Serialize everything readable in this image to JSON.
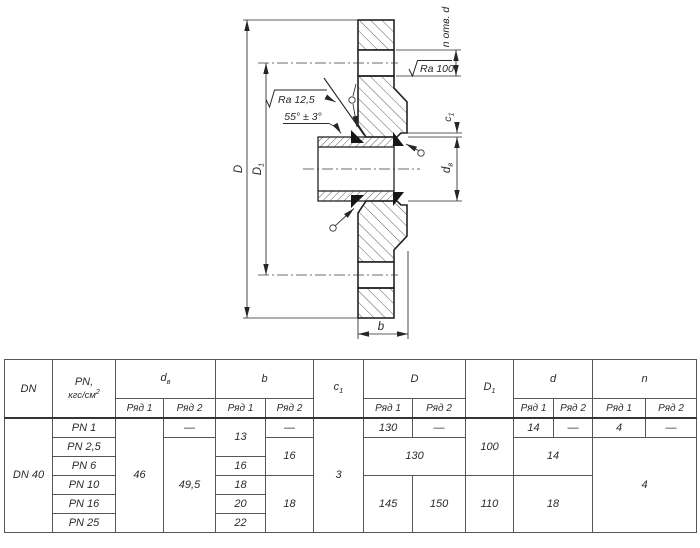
{
  "drawing": {
    "n_holes_label": "n отв. d",
    "ra_face_label": "Ra 100",
    "ra_bevel_label": "Ra 12,5",
    "angle_label": "55° ± 3°",
    "dim_outer_diameter": "D",
    "dim_bolt_circle": {
      "base": "D",
      "sub": "1"
    },
    "dim_chamfer": {
      "base": "c",
      "sub": "1"
    },
    "dim_bore": {
      "base": "d",
      "sub": "в"
    },
    "dim_thickness": "b"
  },
  "table": {
    "header": {
      "dn": "DN",
      "pn_title": "PN,",
      "pn_unit_base": "кгс/см",
      "pn_unit_sup": "2",
      "dv_base": "d",
      "dv_sub": "в",
      "b": "b",
      "c_base": "c",
      "c_sub": "1",
      "D": "D",
      "D1_base": "D",
      "D1_sub": "1",
      "d": "d",
      "n": "n",
      "ryad1": "Ряд 1",
      "ryad2": "Ряд 2"
    },
    "body": {
      "dn": "DN 40",
      "pn": [
        "PN 1",
        "PN 2,5",
        "PN 6",
        "PN 10",
        "PN 16",
        "PN 25"
      ],
      "dash": "—",
      "dv": {
        "r1": "46",
        "r2": "49,5"
      },
      "b": {
        "r1_pn1_2": "13",
        "r1_pn6": "16",
        "r1_pn10": "18",
        "r1_pn16": "20",
        "r1_pn25": "22",
        "r2_pn2_6": "16",
        "r2_pn10_25": "18"
      },
      "c1": "3",
      "D": {
        "r1_pn1": "130",
        "pn2_6": "130",
        "r1_pn10_25": "145",
        "r2_pn10_25": "150"
      },
      "D1": {
        "pn1_6": "100",
        "pn10_25": "110"
      },
      "d": {
        "r1_pn1": "14",
        "pn2_6": "14",
        "pn10_25": "18"
      },
      "n": {
        "r1_pn1": "4",
        "pn2_25": "4"
      }
    }
  }
}
